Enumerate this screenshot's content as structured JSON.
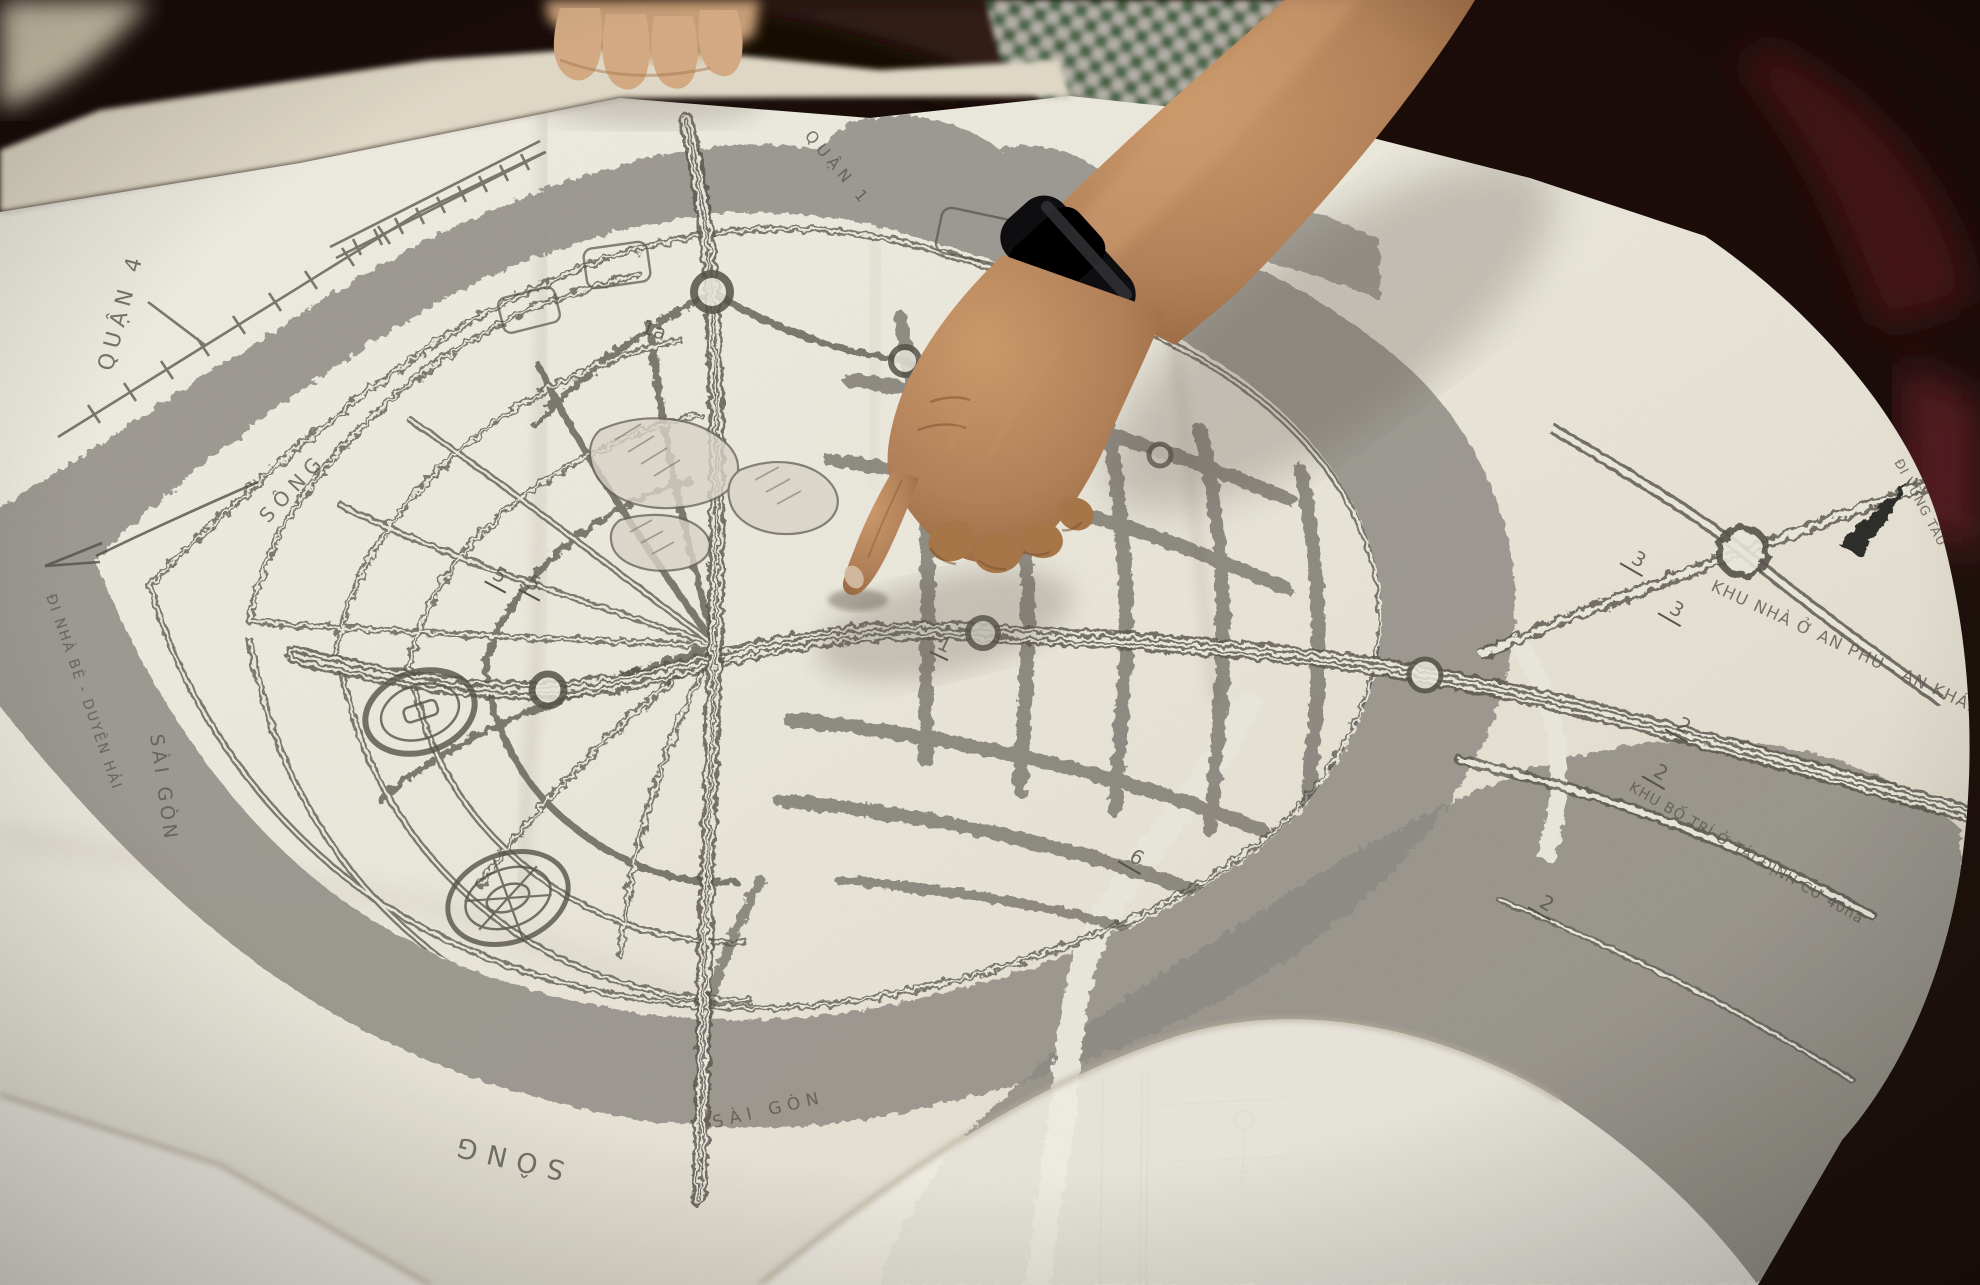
{
  "photo": {
    "subject": "hand pointing at unfolded urban master-plan map",
    "colors": {
      "paper": "#efece3",
      "paper_bright": "#f5f2e9",
      "river_gray": "#94918a",
      "ink": "#55524a",
      "skin": "#b5835a",
      "skin_light": "#d3a276",
      "watch_black": "#0e0e10",
      "shirt_green": "#4f7d55",
      "room_dark": "#1f120d",
      "chair_maroon": "#4a1218"
    }
  },
  "map_labels": {
    "district4": "QUẬN 4",
    "district1": "QUẬN 1",
    "song_left": "SÔNG",
    "saigon_left": "SÀI GÒN",
    "song_topright": "SÔNG",
    "song_bottom": "SÔNG",
    "saigon_bottom": "SÀI GÒN",
    "area_anphu": "KHU NHÀ Ở AN PHÚ - AN KHÁNH",
    "area_resettle": "KHU BỐ TRÍ Ở TÁI ĐỊNH CƯ 40ha",
    "dir_nhabe": "ĐI NHÀ BÈ - DUYÊN HẢI",
    "dir_vungtau": "ĐI VŨNG TÀU",
    "lots": [
      "5",
      "5",
      "1a",
      "1",
      "3",
      "3",
      "2",
      "2",
      "2",
      "6"
    ]
  }
}
